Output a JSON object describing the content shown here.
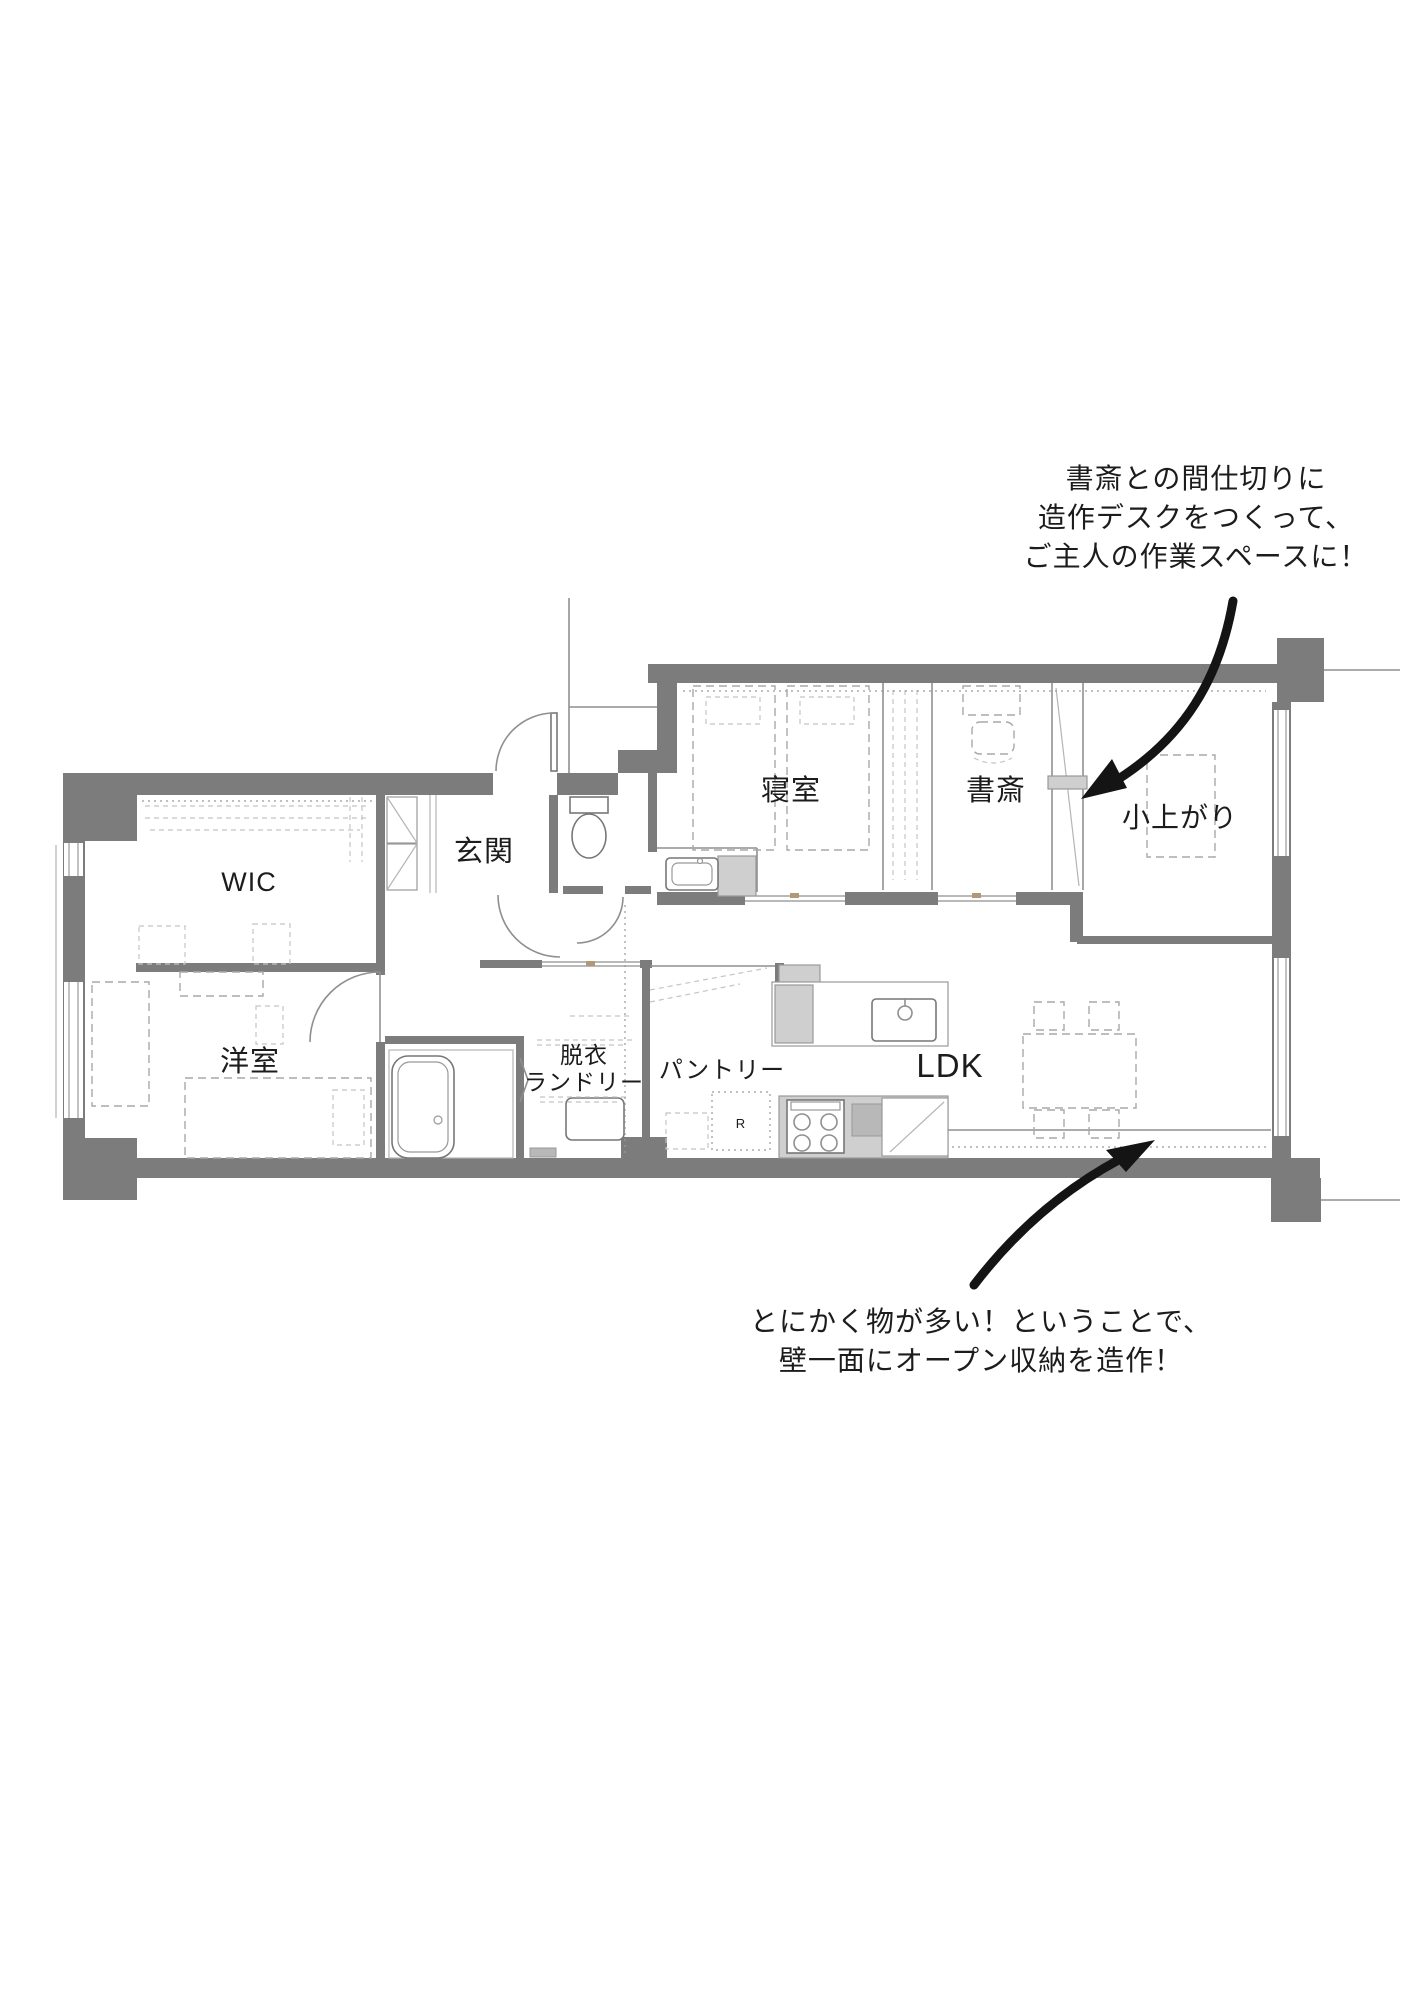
{
  "colors": {
    "wall": "#7c7c7c",
    "thin_line": "#8f8f8f",
    "dashed_furniture": "#a8a8a8",
    "text": "#1c1c1c",
    "arrow": "#141414",
    "counter": "#cfcfcf",
    "background": "#ffffff"
  },
  "rooms": {
    "wic": {
      "label": "WIC"
    },
    "genkan": {
      "label": "玄関"
    },
    "bedroom": {
      "label": "寝室"
    },
    "study": {
      "label": "書斎"
    },
    "koagari": {
      "label": "小上がり"
    },
    "western_room": {
      "label": "洋室"
    },
    "laundry": {
      "line1": "脱衣",
      "line2": "ランドリー"
    },
    "pantry": {
      "label": "パントリー"
    },
    "ldk": {
      "label": "LDK"
    },
    "fridge": {
      "label": "R"
    }
  },
  "annotations": {
    "study_note": {
      "lines": [
        "書斎との間仕切りに",
        "造作デスクをつくって、",
        "ご主人の作業スペースに！"
      ]
    },
    "storage_note": {
      "lines": [
        "とにかく物が多い！ということで、",
        "壁一面にオープン収納を造作！"
      ]
    }
  }
}
